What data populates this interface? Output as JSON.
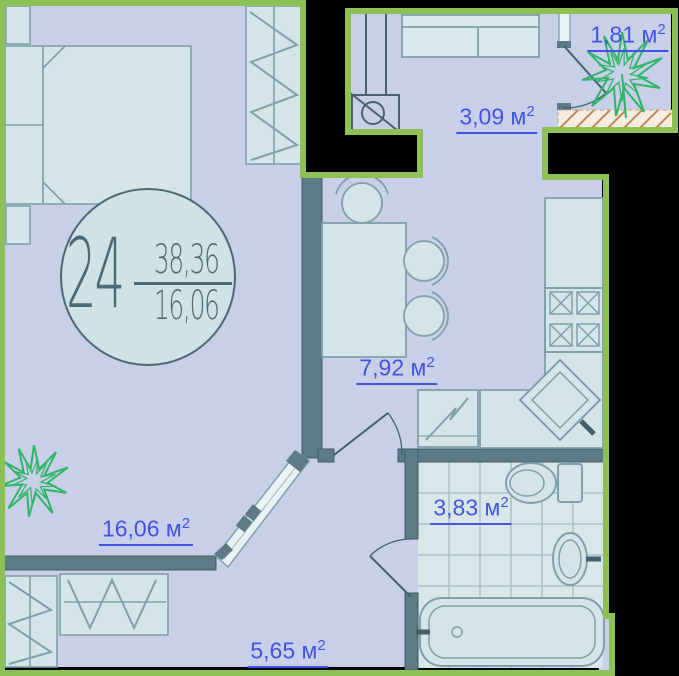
{
  "unit": {
    "number": "24",
    "total_area": "38,36",
    "living_area": "16,06"
  },
  "areas": {
    "balcony": {
      "text": "1,81 м",
      "sup": "2"
    },
    "entry_hall": {
      "text": "3,09 м",
      "sup": "2"
    },
    "kitchen": {
      "text": "7,92 м",
      "sup": "2"
    },
    "bathroom": {
      "text": "3,83 м",
      "sup": "2"
    },
    "living_room": {
      "text": "16,06 м",
      "sup": "2"
    },
    "hallway": {
      "text": "5,65 м",
      "sup": "2"
    }
  },
  "colors": {
    "outline_green": "#8ec155",
    "floor_lavender": "#c8cfe8",
    "wall_dark": "#5d7b85",
    "furniture_fill": "#d3e5e8",
    "furniture_stroke": "#7fa0aa",
    "area_label_blue": "#4353df",
    "badge_text": "#4c6a74",
    "plant_green": "#2eb567",
    "hatch_orange": "#c28757",
    "tile_grid": "#a4bcc4"
  }
}
